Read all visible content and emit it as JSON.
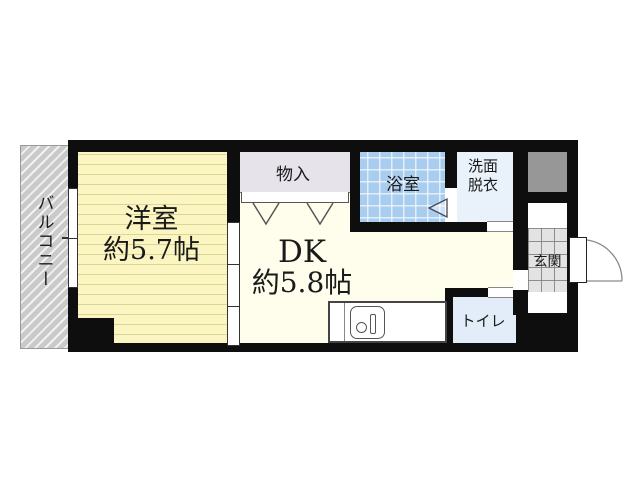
{
  "plan_type": "apartment-floor-plan",
  "rooms": {
    "balcony": {
      "label": "バルコニー"
    },
    "western_room": {
      "name_line": "洋室",
      "size_line": "約5.7帖"
    },
    "closet": {
      "label": "物入"
    },
    "bath": {
      "label": "浴室"
    },
    "washroom": {
      "line1": "洗面",
      "line2": "脱衣"
    },
    "dk": {
      "name_line": "DK",
      "size_line": "約5.8帖"
    },
    "entrance": {
      "label": "玄関"
    },
    "toilet": {
      "label": "トイレ"
    }
  },
  "icons": {
    "kitchen_sink": "sink-with-drain-and-faucet",
    "entrance_door": "quarter-circle-door-swing",
    "closet_doors": "two-v-folding-door-marks",
    "bath_door": "left-pointing-triangle-door-mark",
    "window": "double-segment-window-on-left-wall",
    "sliding_door": "three-panel-sliding-door"
  },
  "colors": {
    "wall": "#0e0e0e",
    "western_room_fill": "#fbf5c2",
    "dk_fill": "#fffeec",
    "closet_fill": "#e6e3ea",
    "bath_fill": "#a9cdef",
    "washroom_fill": "#e9f1fb",
    "toilet_fill": "#e3edf9",
    "shaft_fill": "#979797",
    "entrance_tile_fill": "#e3e3e3",
    "balcony_fill": "#cacaca"
  }
}
